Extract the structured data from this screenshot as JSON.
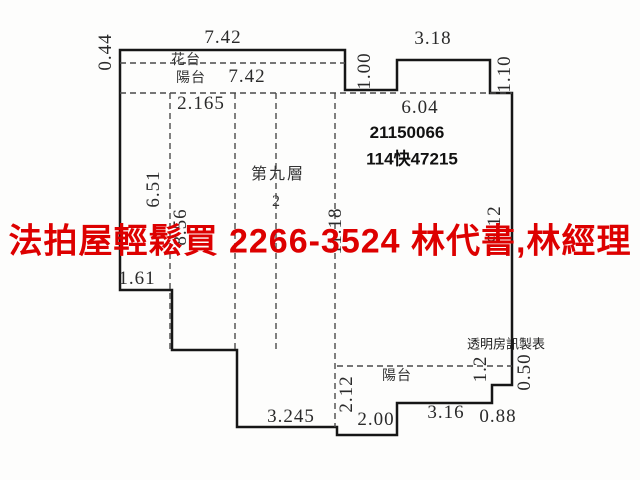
{
  "watermark": {
    "text": "法拍屋輕鬆買  2266-3524  林代書,林經理",
    "color": "#dd0000"
  },
  "colors": {
    "wall": "#161616",
    "dashed_line": "#4a4a4a",
    "background": "#fdfdfc",
    "dimension_text": "#2a2a2a"
  },
  "plan": {
    "floor_label": "第九層",
    "unit_label": "2",
    "case_numbers": {
      "line1": "21150066",
      "line2": "114快47215"
    },
    "credit": "透明房訊製表",
    "balcony_top_label": "陽台",
    "balcony_bottom_label": "陽台",
    "planter_label": "花台",
    "labels": [
      {
        "text": "7.42",
        "x": 223,
        "y": 38,
        "rot": 0,
        "kind": "dim"
      },
      {
        "text": "0.44",
        "x": 106,
        "y": 52,
        "rot": -90,
        "kind": "dim"
      },
      {
        "text": "花台",
        "x": 186,
        "y": 59,
        "rot": 0,
        "kind": "area"
      },
      {
        "text": "陽台",
        "x": 191,
        "y": 77,
        "rot": 0,
        "kind": "area"
      },
      {
        "text": "7.42",
        "x": 247,
        "y": 77,
        "rot": 0,
        "kind": "dim"
      },
      {
        "text": "2.165",
        "x": 201,
        "y": 104,
        "rot": 0,
        "kind": "dim"
      },
      {
        "text": "1.00",
        "x": 365,
        "y": 71,
        "rot": -90,
        "kind": "dim"
      },
      {
        "text": "3.18",
        "x": 433,
        "y": 39,
        "rot": 0,
        "kind": "dim"
      },
      {
        "text": "1.10",
        "x": 505,
        "y": 74,
        "rot": -90,
        "kind": "dim"
      },
      {
        "text": "6.04",
        "x": 420,
        "y": 108,
        "rot": 0,
        "kind": "dim"
      },
      {
        "text": "21150066",
        "x": 407,
        "y": 133,
        "rot": 0,
        "kind": "case"
      },
      {
        "text": "114快47215",
        "x": 412,
        "y": 157,
        "rot": 0,
        "kind": "case"
      },
      {
        "text": "第九層",
        "x": 278,
        "y": 172,
        "rot": 0,
        "kind": "room"
      },
      {
        "text": "2",
        "x": 277,
        "y": 202,
        "rot": 0,
        "kind": "room"
      },
      {
        "text": "6.51",
        "x": 154,
        "y": 189,
        "rot": -90,
        "kind": "dim"
      },
      {
        "text": "8.56",
        "x": 181,
        "y": 227,
        "rot": -90,
        "kind": "dim"
      },
      {
        "text": "11.18",
        "x": 336,
        "y": 231,
        "rot": -90,
        "kind": "dim"
      },
      {
        "text": "9.12",
        "x": 495,
        "y": 224,
        "rot": -90,
        "kind": "dim"
      },
      {
        "text": "1.61",
        "x": 137,
        "y": 279,
        "rot": 0,
        "kind": "dim"
      },
      {
        "text": "3.245",
        "x": 291,
        "y": 417,
        "rot": 0,
        "kind": "dim"
      },
      {
        "text": "2.12",
        "x": 347,
        "y": 394,
        "rot": -90,
        "kind": "dim"
      },
      {
        "text": "2.00",
        "x": 376,
        "y": 420,
        "rot": 0,
        "kind": "dim"
      },
      {
        "text": "陽台",
        "x": 397,
        "y": 375,
        "rot": 0,
        "kind": "area"
      },
      {
        "text": "1.2",
        "x": 481,
        "y": 369,
        "rot": -90,
        "kind": "dim"
      },
      {
        "text": "0.50",
        "x": 525,
        "y": 372,
        "rot": -90,
        "kind": "dim"
      },
      {
        "text": "3.16",
        "x": 446,
        "y": 413,
        "rot": 0,
        "kind": "dim"
      },
      {
        "text": "0.88",
        "x": 498,
        "y": 417,
        "rot": 0,
        "kind": "dim"
      },
      {
        "text": "透明房訊製表",
        "x": 506,
        "y": 343,
        "rot": 0,
        "kind": "credit"
      }
    ]
  }
}
